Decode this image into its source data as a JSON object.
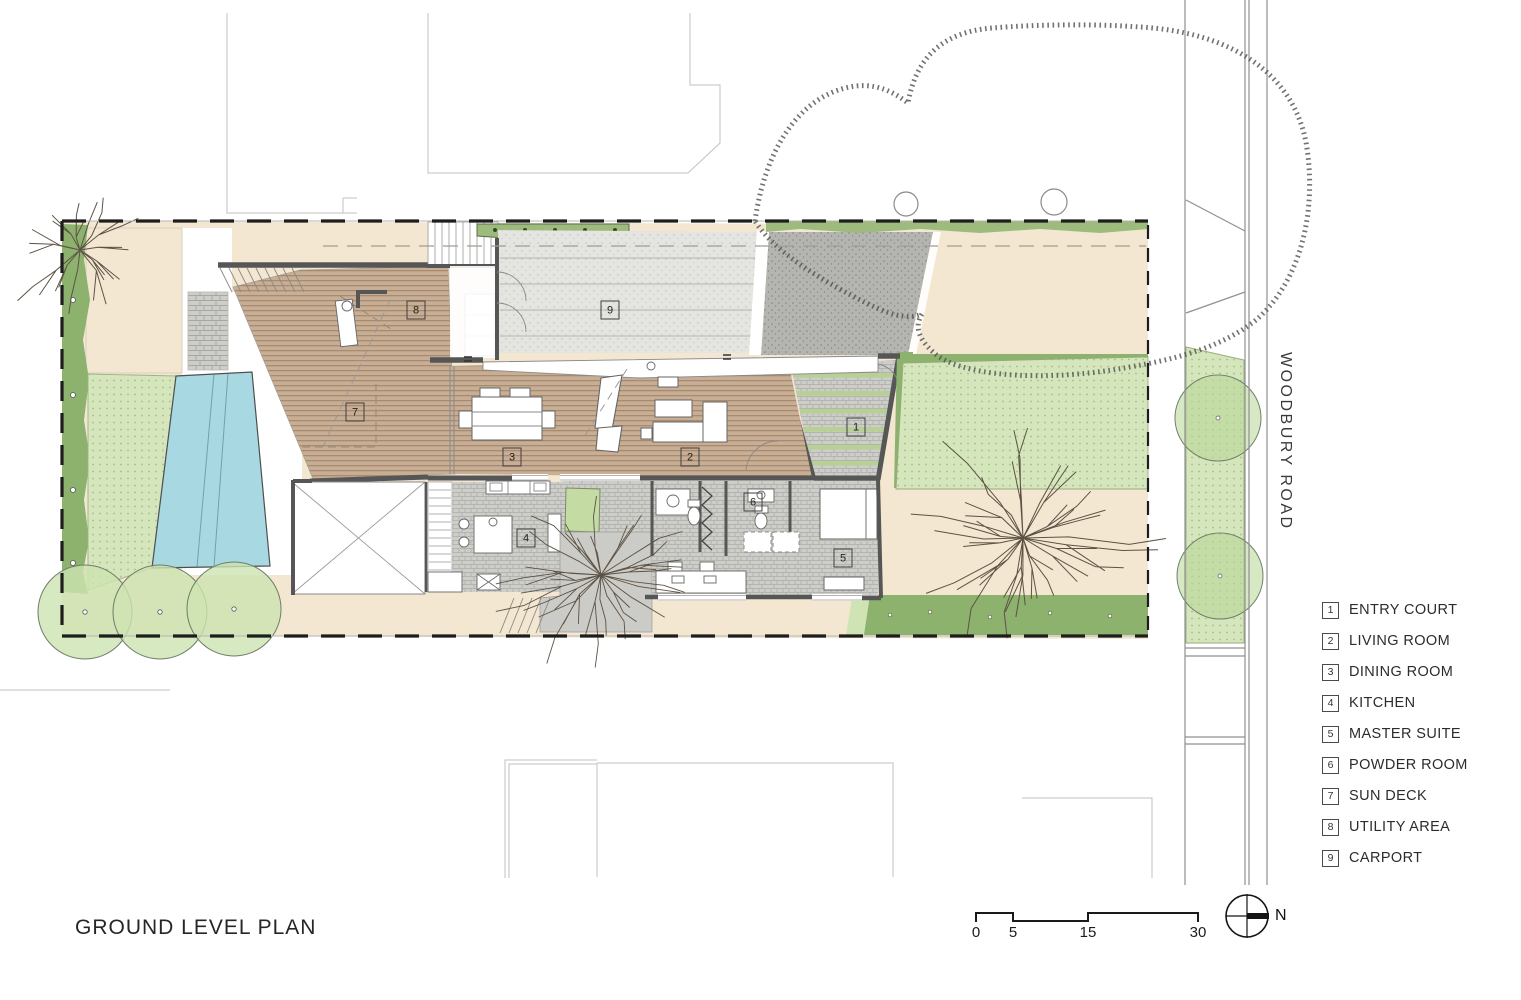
{
  "title": "GROUND LEVEL PLAN",
  "road_label": "WOODBURY ROAD",
  "north_label": "N",
  "scale_bar": {
    "ticks": [
      "0",
      "5",
      "15",
      "30"
    ]
  },
  "legend": {
    "items": [
      {
        "num": "1",
        "label": "ENTRY COURT"
      },
      {
        "num": "2",
        "label": "LIVING ROOM"
      },
      {
        "num": "3",
        "label": "DINING ROOM"
      },
      {
        "num": "4",
        "label": "KITCHEN"
      },
      {
        "num": "5",
        "label": "MASTER SUITE"
      },
      {
        "num": "6",
        "label": "POWDER ROOM"
      },
      {
        "num": "7",
        "label": "SUN DECK"
      },
      {
        "num": "8",
        "label": "UTILITY AREA"
      },
      {
        "num": "9",
        "label": "CARPORT"
      }
    ]
  },
  "room_markers": [
    {
      "num": "1",
      "x": 856,
      "y": 427
    },
    {
      "num": "2",
      "x": 690,
      "y": 457
    },
    {
      "num": "3",
      "x": 512,
      "y": 457
    },
    {
      "num": "4",
      "x": 526,
      "y": 538
    },
    {
      "num": "5",
      "x": 843,
      "y": 558
    },
    {
      "num": "6",
      "x": 753,
      "y": 502
    },
    {
      "num": "7",
      "x": 355,
      "y": 412
    },
    {
      "num": "8",
      "x": 416,
      "y": 310
    },
    {
      "num": "9",
      "x": 610,
      "y": 310
    }
  ],
  "colors": {
    "tan": "#f3e7d2",
    "wood": "#c8ae94",
    "lawn": "#d5e6bc",
    "hedge": "#8cb26e",
    "hedgelight": "#cfe3b4",
    "pool": "#a8d8e2",
    "conc": "#e4e4e0",
    "drive": "#b4b4b0",
    "pave": "#cdcdc9",
    "planter": "#9cbb7c",
    "stripgreen": "#b7d094",
    "wall": "#565656",
    "ink": "#2b2b2b"
  }
}
